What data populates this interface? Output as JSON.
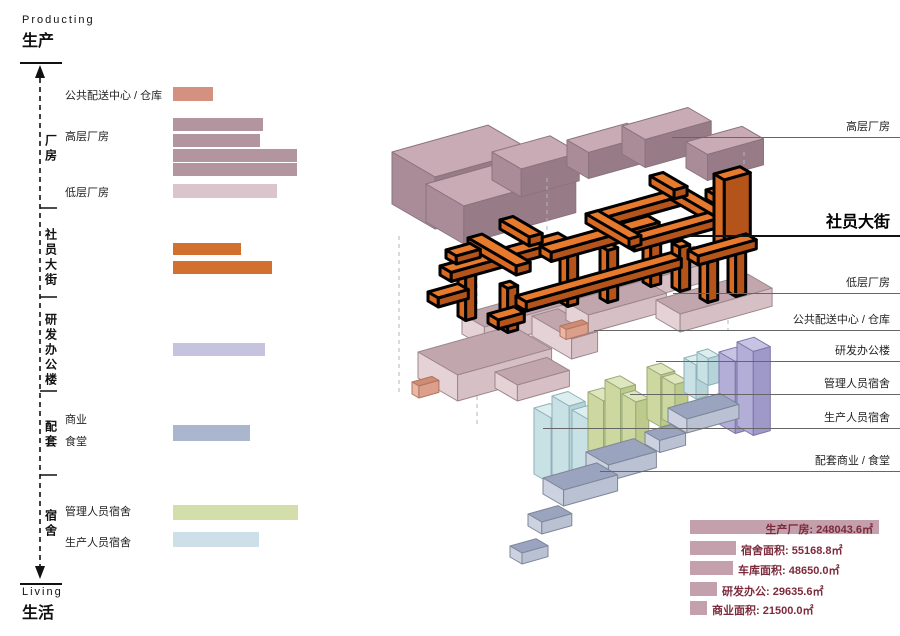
{
  "axis": {
    "top_label_en": "Producting",
    "top_label_zh": "生产",
    "bottom_label_en": "Living",
    "bottom_label_zh": "生活"
  },
  "left_panel": {
    "sections": [
      {
        "label": "厂房",
        "top": 118,
        "height": 62
      },
      {
        "label": "社员大街",
        "top": 220,
        "height": 76
      },
      {
        "label": "研发办公楼",
        "top": 304,
        "height": 92
      },
      {
        "label": "配套",
        "top": 412,
        "height": 46
      },
      {
        "label": "宿舍",
        "top": 499,
        "height": 50
      }
    ],
    "row_labels": [
      {
        "id": "distribution-warehouse",
        "label": "公共配送中心 / 仓库",
        "top": 87
      },
      {
        "id": "highrise-factory",
        "label": "高层厂房",
        "top": 128
      },
      {
        "id": "lowrise-factory",
        "label": "低层厂房",
        "top": 184
      },
      {
        "id": "commercial",
        "label": "商业",
        "top": 411
      },
      {
        "id": "canteen",
        "label": "食堂",
        "top": 433
      },
      {
        "id": "manager-dorm",
        "label": "管理人员宿舍",
        "top": 503
      },
      {
        "id": "worker-dorm",
        "label": "生产人员宿舍",
        "top": 534
      }
    ],
    "bars": [
      {
        "id": "distribution-warehouse",
        "top": 87,
        "width": 40,
        "height": 14,
        "color": "salmon"
      },
      {
        "id": "highrise-1",
        "top": 118,
        "width": 90,
        "height": 13,
        "color": "mauve"
      },
      {
        "id": "highrise-2",
        "top": 134,
        "width": 87,
        "height": 13,
        "color": "mauve"
      },
      {
        "id": "highrise-3",
        "top": 149,
        "width": 124,
        "height": 13,
        "color": "mauve"
      },
      {
        "id": "highrise-4",
        "top": 163,
        "width": 124,
        "height": 13,
        "color": "mauve"
      },
      {
        "id": "lowrise",
        "top": 184,
        "width": 104,
        "height": 14,
        "color": "light_pink"
      },
      {
        "id": "street-1",
        "top": 243,
        "width": 68,
        "height": 12,
        "color": "orange"
      },
      {
        "id": "street-2",
        "top": 261,
        "width": 99,
        "height": 13,
        "color": "orange"
      },
      {
        "id": "rnd-office",
        "top": 343,
        "width": 92,
        "height": 13,
        "color": "lavender"
      },
      {
        "id": "commercial-canteen",
        "top": 425,
        "width": 77,
        "height": 16,
        "color": "blue_gray"
      },
      {
        "id": "manager-dorm",
        "top": 505,
        "width": 125,
        "height": 15,
        "color": "green"
      },
      {
        "id": "worker-dorm",
        "top": 532,
        "width": 86,
        "height": 15,
        "color": "light_blue"
      }
    ]
  },
  "right_labels": [
    {
      "id": "highrise-factory",
      "label": "高层厂房",
      "top": 118,
      "line_left": 672,
      "emphasis": false
    },
    {
      "id": "shyuan-street",
      "label": "社员大街",
      "top": 208,
      "line_left": 686,
      "emphasis": true
    },
    {
      "id": "lowrise-factory",
      "label": "低层厂房",
      "top": 274,
      "line_left": 673,
      "emphasis": false
    },
    {
      "id": "distribution-warehouse",
      "label": "公共配送中心 / 仓库",
      "top": 311,
      "line_left": 594,
      "emphasis": false
    },
    {
      "id": "rnd-office",
      "label": "研发办公楼",
      "top": 342,
      "line_left": 656,
      "emphasis": false
    },
    {
      "id": "manager-dorm",
      "label": "管理人员宿舍",
      "top": 375,
      "line_left": 630,
      "emphasis": false
    },
    {
      "id": "worker-dorm",
      "label": "生产人员宿舍",
      "top": 409,
      "line_left": 543,
      "emphasis": false
    },
    {
      "id": "commercial-canteen",
      "label": "配套商业 / 食堂",
      "top": 452,
      "line_left": 600,
      "emphasis": false
    }
  ],
  "stats": [
    {
      "id": "factory",
      "label": "生产厂房",
      "value": "248043.6㎡",
      "top": 520,
      "bar_width": 189,
      "text_inside": true
    },
    {
      "id": "dormitory",
      "label": "宿舍面积",
      "value": "55168.8㎡",
      "top": 541,
      "bar_width": 46,
      "text_inside": false
    },
    {
      "id": "garage",
      "label": "车库面积",
      "value": "48650.0㎡",
      "top": 561,
      "bar_width": 43,
      "text_inside": false
    },
    {
      "id": "rnd",
      "label": "研发办公",
      "value": "29635.6㎡",
      "top": 582,
      "bar_width": 27,
      "text_inside": false
    },
    {
      "id": "commercial",
      "label": "商业面积",
      "value": "21500.0㎡",
      "top": 601,
      "bar_width": 17,
      "text_inside": false
    }
  ],
  "palette": {
    "bar_colors": {
      "salmon": "#d4917f",
      "mauve": "#b2959f",
      "light_pink": "#d9c5cb",
      "orange": "#d2702f",
      "lavender": "#c5c3dd",
      "blue_gray": "#aab6ce",
      "green": "#d3deab",
      "light_blue": "#cde0ea"
    },
    "stats_bar": "#c4a0ac",
    "stats_text": "#7c2b3c",
    "leader_line": "#666666",
    "axis_line": "#111111",
    "materials": {
      "mauve": [
        "#c9abb5",
        "#a98c97",
        "#977c87",
        "#8a737d"
      ],
      "pink": [
        "#c2a6ad",
        "#e4d2d6",
        "#d6c0c6",
        "#9c868c"
      ],
      "salmon": [
        "#d08b74",
        "#e9b7a6",
        "#dc9f8b",
        "#b0755f"
      ],
      "orange": [
        "#e87a2e",
        "#d96a24",
        "#b5541a",
        "#000000"
      ],
      "purple": [
        "#c7c3e3",
        "#b3aed8",
        "#9f99c9",
        "#7d76a8"
      ],
      "green": [
        "#dde6bc",
        "#ccd89f",
        "#bcca8c",
        "#9aa878"
      ],
      "cyan": [
        "#ddeef0",
        "#c8e1e5",
        "#b5d4da",
        "#8fb0b8"
      ],
      "gray_blue": [
        "#9aa4be",
        "#ccd2df",
        "#bac1d2",
        "#7d8699"
      ]
    }
  },
  "chart_data": [
    {
      "type": "bar",
      "title": "功能体量条形图 (program bars, relative length px)",
      "categories": [
        "公共配送中心/仓库",
        "高层厂房-1",
        "高层厂房-2",
        "高层厂房-3",
        "高层厂房-4",
        "低层厂房",
        "社员大街-1",
        "社员大街-2",
        "研发办公楼",
        "配套商业/食堂",
        "管理人员宿舍",
        "生产人员宿舍"
      ],
      "values": [
        40,
        90,
        87,
        124,
        124,
        104,
        68,
        99,
        92,
        77,
        125,
        86
      ],
      "xlabel": "",
      "ylabel": "",
      "legend": false
    },
    {
      "type": "bar",
      "title": "面积统计",
      "categories": [
        "生产厂房",
        "宿舍面积",
        "车库面积",
        "研发办公",
        "商业面积"
      ],
      "values": [
        248043.6,
        55168.8,
        48650.0,
        29635.6,
        21500.0
      ],
      "unit": "㎡",
      "xlabel": "",
      "ylabel": ""
    }
  ]
}
